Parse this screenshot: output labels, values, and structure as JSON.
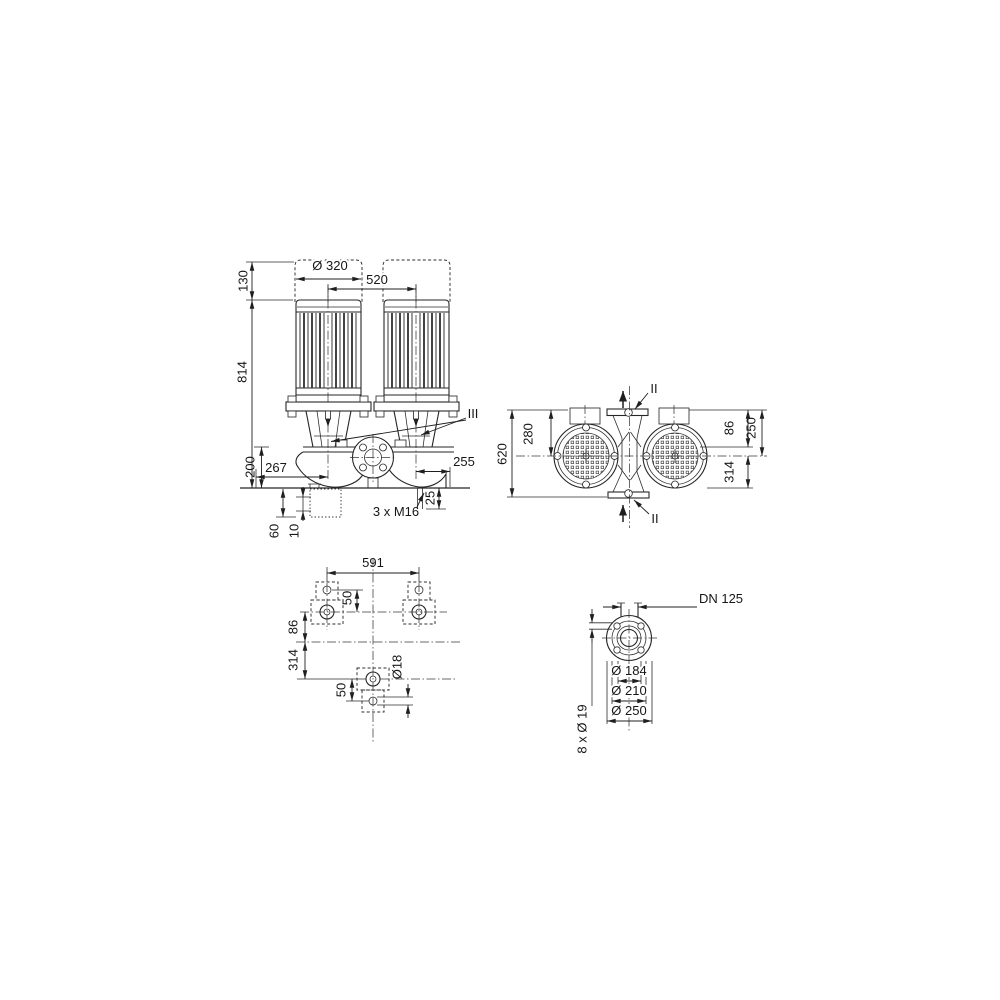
{
  "colors": {
    "ink": "#1f1f1f",
    "background": "#ffffff"
  },
  "views": {
    "front": {
      "d130": "130",
      "d320": "Ø 320",
      "d520": "520",
      "d814": "814",
      "d200": "200",
      "d267": "267",
      "d255": "255",
      "d25": "25",
      "m16": "3 x M16",
      "d60": "60",
      "d10": "10",
      "section_III": "III"
    },
    "top": {
      "d620": "620",
      "d280": "280",
      "d86": "86",
      "d250": "250",
      "d314": "314",
      "section_II_top": "II",
      "section_II_bottom": "II"
    },
    "foundation": {
      "d591": "591",
      "d50_upper": "50",
      "d86": "86",
      "d314": "314",
      "d50_lower": "50",
      "d18": "Ø18"
    },
    "flange": {
      "dn": "DN 125",
      "d184": "Ø 184",
      "d210": "Ø 210",
      "d250": "Ø 250",
      "bolts": "8 x Ø 19"
    }
  }
}
